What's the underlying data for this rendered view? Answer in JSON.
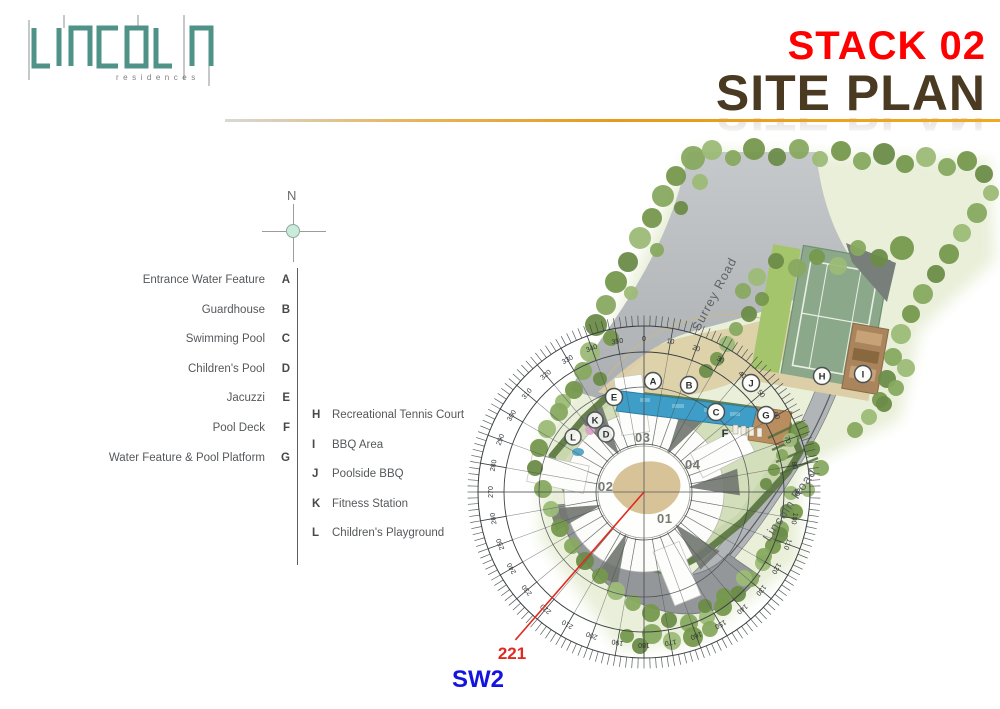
{
  "header": {
    "logo": {
      "name": "LINCOLN",
      "subtitle": "residences"
    },
    "title_line1": "STACK 02",
    "title_line2": "SITE PLAN"
  },
  "compass": {
    "north_label": "N"
  },
  "legend": {
    "left": [
      {
        "label": "Entrance Water Feature",
        "key": "A"
      },
      {
        "label": "Guardhouse",
        "key": "B"
      },
      {
        "label": "Swimming Pool",
        "key": "C"
      },
      {
        "label": "Children's Pool",
        "key": "D"
      },
      {
        "label": "Jacuzzi",
        "key": "E"
      },
      {
        "label": "Pool Deck",
        "key": "F"
      },
      {
        "label": "Water Feature & Pool Platform",
        "key": "G"
      }
    ],
    "right": [
      {
        "key": "H",
        "label": "Recreational Tennis Court"
      },
      {
        "key": "I",
        "label": "BBQ Area"
      },
      {
        "key": "J",
        "label": "Poolside BBQ"
      },
      {
        "key": "K",
        "label": "Fitness Station"
      },
      {
        "key": "L",
        "label": "Children's Playground"
      }
    ]
  },
  "site_plan": {
    "roads": [
      {
        "name": "Surrey Road"
      },
      {
        "name": "Lincoln Road"
      }
    ],
    "stacks": [
      {
        "id": "01"
      },
      {
        "id": "02"
      },
      {
        "id": "03"
      },
      {
        "id": "04"
      }
    ],
    "markers": [
      {
        "letter": "A"
      },
      {
        "letter": "B"
      },
      {
        "letter": "C"
      },
      {
        "letter": "D"
      },
      {
        "letter": "E"
      },
      {
        "letter": "F"
      },
      {
        "letter": "G"
      },
      {
        "letter": "H"
      },
      {
        "letter": "I"
      },
      {
        "letter": "J"
      },
      {
        "letter": "K"
      },
      {
        "letter": "L"
      }
    ],
    "dial": {
      "degree_labels": [
        0,
        10,
        20,
        30,
        40,
        50,
        60,
        70,
        80,
        90,
        100,
        110,
        120,
        130,
        140,
        150,
        160,
        170,
        180,
        190,
        200,
        210,
        220,
        230,
        240,
        250,
        260,
        270,
        280,
        290,
        300,
        310,
        320,
        330,
        340,
        350
      ]
    },
    "bearing": {
      "value": "221",
      "direction": "SW2"
    }
  },
  "colors": {
    "accent_line": "#E79A1C",
    "title1": "#FF0000",
    "title2": "#4A3A22",
    "logo_teal": "#4F9287",
    "bearing_red": "#E02A20",
    "direction_blue": "#1414E0"
  }
}
